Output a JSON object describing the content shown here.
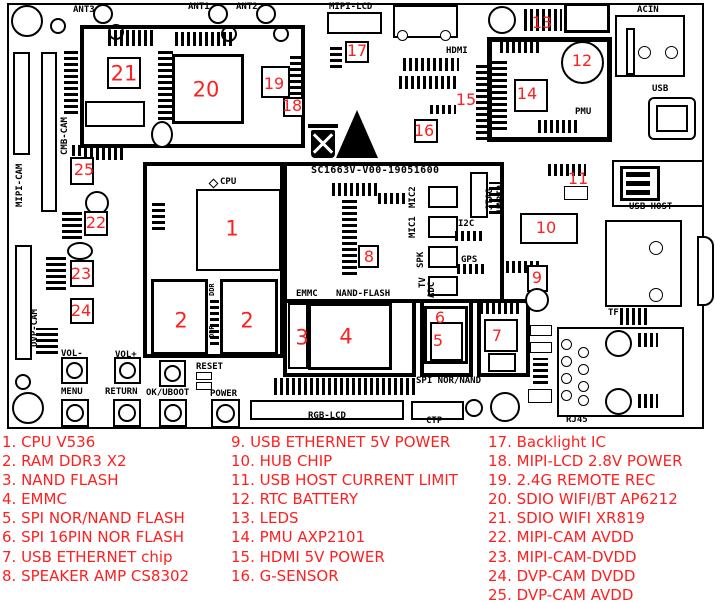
{
  "meta": {
    "type": "pcb-component-location-diagram"
  },
  "colors": {
    "marker_red": "#ff1f1f",
    "legend_red": "#ff1f1f",
    "silkscreen": "#000000",
    "background": "#ffffff"
  },
  "board": {
    "silkscreen_id": "SC1663V-V00-19051600",
    "labels": [
      {
        "text": "ANT3",
        "x": 73,
        "y": 6
      },
      {
        "text": "ANT1",
        "x": 188,
        "y": 3
      },
      {
        "text": "ANT2",
        "x": 236,
        "y": 3
      },
      {
        "text": "MIPI-LCD",
        "x": 329,
        "y": 3
      },
      {
        "text": "HDMI",
        "x": 446,
        "y": 47
      },
      {
        "text": "ACIN",
        "x": 637,
        "y": 6
      },
      {
        "text": "USB",
        "x": 652,
        "y": 85
      },
      {
        "text": "PMU",
        "x": 575,
        "y": 108
      },
      {
        "text": "USB-HOST",
        "x": 629,
        "y": 203
      },
      {
        "text": "TF",
        "x": 608,
        "y": 309
      },
      {
        "text": "RJ45",
        "x": 566,
        "y": 416
      },
      {
        "text": "CPU",
        "x": 220,
        "y": 178
      },
      {
        "text": "EMMC",
        "x": 296,
        "y": 290
      },
      {
        "text": "NAND-FLASH",
        "x": 336,
        "y": 290
      },
      {
        "text": "SPI NOR/NAND",
        "x": 416,
        "y": 377
      },
      {
        "text": "RGB-LCD",
        "x": 308,
        "y": 412
      },
      {
        "text": "CTP",
        "x": 426,
        "y": 417
      },
      {
        "text": "I2C",
        "x": 458,
        "y": 220
      },
      {
        "text": "GPS",
        "x": 461,
        "y": 256
      },
      {
        "text": "VOL-",
        "x": 61,
        "y": 350
      },
      {
        "text": "VOL+",
        "x": 115,
        "y": 351
      },
      {
        "text": "MENU",
        "x": 61,
        "y": 388
      },
      {
        "text": "RETURN",
        "x": 105,
        "y": 388
      },
      {
        "text": "OK/UBOOT",
        "x": 146,
        "y": 389
      },
      {
        "text": "RESET",
        "x": 196,
        "y": 363
      },
      {
        "text": "POWER",
        "x": 210,
        "y": 390
      },
      {
        "text": "CMB-CAM",
        "x": 61,
        "y": 155,
        "v": 1
      },
      {
        "text": "MIPI-CAM",
        "x": 16,
        "y": 207,
        "v": 1
      },
      {
        "text": "DVP-CAM",
        "x": 31,
        "y": 347,
        "v": 1
      },
      {
        "text": "MIC2",
        "x": 409,
        "y": 208,
        "v": 1
      },
      {
        "text": "MIC1",
        "x": 409,
        "y": 238,
        "v": 1
      },
      {
        "text": "SPK",
        "x": 417,
        "y": 268,
        "v": 1
      },
      {
        "text": "TV",
        "x": 419,
        "y": 288,
        "v": 1
      },
      {
        "text": "ADC",
        "x": 428,
        "y": 298,
        "v": 1
      },
      {
        "text": "JTAG",
        "x": 486,
        "y": 210,
        "v": 1
      },
      {
        "text": "UART0",
        "x": 497,
        "y": 212,
        "v": 1
      },
      {
        "text": "DDR",
        "x": 209,
        "y": 296,
        "v": 1,
        "size": "xs"
      },
      {
        "text": "DDR",
        "x": 209,
        "y": 338,
        "v": 1,
        "size": "xs"
      },
      {
        "text": "SC1663V-V00-19051600",
        "x": 311,
        "y": 165,
        "size": "id"
      }
    ],
    "markers": [
      {
        "n": "1",
        "x": 232,
        "y": 229,
        "s": "lg"
      },
      {
        "n": "2",
        "x": 181,
        "y": 321,
        "s": "lg"
      },
      {
        "n": "2",
        "x": 247,
        "y": 321,
        "s": "lg"
      },
      {
        "n": "3",
        "x": 302,
        "y": 338,
        "s": "lg"
      },
      {
        "n": "4",
        "x": 346,
        "y": 337,
        "s": "lg"
      },
      {
        "n": "5",
        "x": 438,
        "y": 341,
        "s": "sm"
      },
      {
        "n": "6",
        "x": 440,
        "y": 318,
        "s": "sm"
      },
      {
        "n": "7",
        "x": 497,
        "y": 336,
        "s": "sm"
      },
      {
        "n": "8",
        "x": 369,
        "y": 257,
        "s": "sm"
      },
      {
        "n": "9",
        "x": 537,
        "y": 278,
        "s": "sm"
      },
      {
        "n": "10",
        "x": 546,
        "y": 228,
        "s": "sm"
      },
      {
        "n": "11",
        "x": 578,
        "y": 179,
        "s": "sm"
      },
      {
        "n": "12",
        "x": 582,
        "y": 61,
        "s": "sm"
      },
      {
        "n": "13",
        "x": 542,
        "y": 23,
        "s": "sm"
      },
      {
        "n": "14",
        "x": 527,
        "y": 94,
        "s": "sm"
      },
      {
        "n": "15",
        "x": 466,
        "y": 100,
        "s": "sm"
      },
      {
        "n": "16",
        "x": 424,
        "y": 131,
        "s": "sm"
      },
      {
        "n": "17",
        "x": 357,
        "y": 51,
        "s": "sm"
      },
      {
        "n": "18",
        "x": 292,
        "y": 106,
        "s": "sm"
      },
      {
        "n": "19",
        "x": 274,
        "y": 84,
        "s": "sm"
      },
      {
        "n": "20",
        "x": 206,
        "y": 90,
        "s": "lg"
      },
      {
        "n": "21",
        "x": 124,
        "y": 74,
        "s": "lg"
      },
      {
        "n": "22",
        "x": 96,
        "y": 223,
        "s": "sm"
      },
      {
        "n": "23",
        "x": 81,
        "y": 274,
        "s": "sm"
      },
      {
        "n": "24",
        "x": 81,
        "y": 311,
        "s": "sm"
      },
      {
        "n": "25",
        "x": 84,
        "y": 170,
        "s": "sm"
      }
    ]
  },
  "legend": {
    "columns": [
      {
        "x": 2,
        "items": [
          "1. CPU V536",
          "2. RAM DDR3 X2",
          "3. NAND FLASH",
          "4. EMMC",
          "5. SPI NOR/NAND FLASH",
          "6. SPI 16PIN NOR FLASH",
          "7. USB ETHERNET chip",
          "8. SPEAKER AMP CS8302"
        ]
      },
      {
        "x": 231,
        "items": [
          "9. USB ETHERNET 5V POWER",
          "10. HUB CHIP",
          "11. USB HOST CURRENT LIMIT",
          "12. RTC BATTERY",
          "13. LEDS",
          "14. PMU AXP2101",
          "15. HDMI 5V POWER",
          "16. G-SENSOR"
        ]
      },
      {
        "x": 488,
        "items": [
          "17. Backlight IC",
          "18. MIPI-LCD 2.8V POWER",
          "19. 2.4G REMOTE REC",
          "20. SDIO WIFI/BT AP6212",
          "21. SDIO WIFI XR819",
          "22. MIPI-CAM AVDD",
          "23. MIPI-CAM-DVDD",
          "24. DVP-CAM DVDD",
          "25. DVP-CAM AVDD"
        ]
      }
    ]
  }
}
